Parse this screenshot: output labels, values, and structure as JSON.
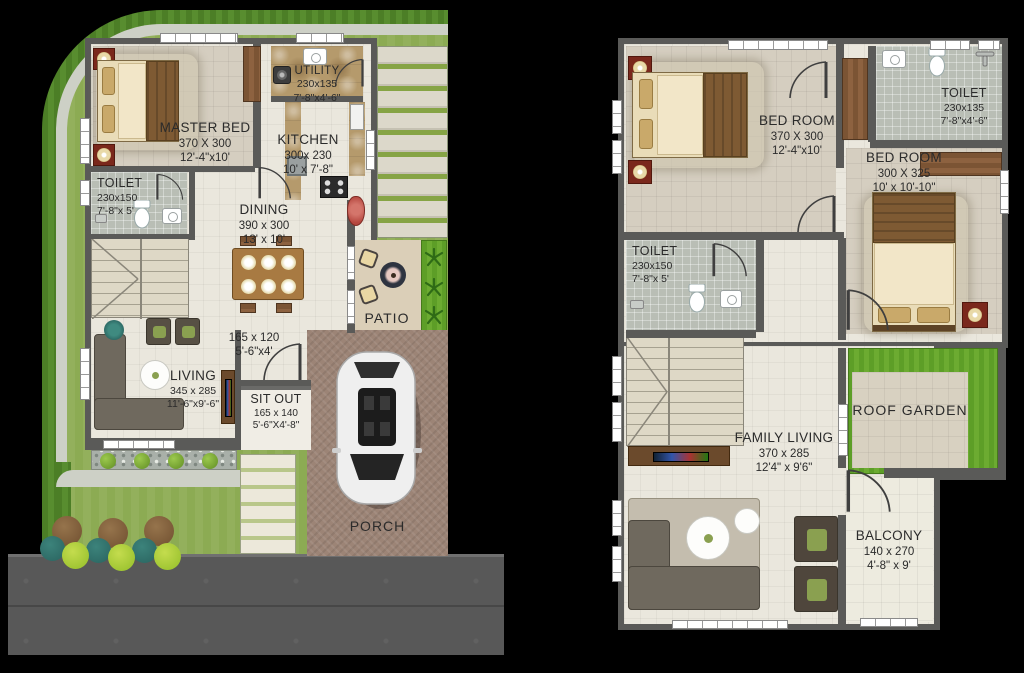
{
  "plans": {
    "ground_floor_note": "left plan",
    "first_floor_note": "right plan"
  },
  "ground_floor": {
    "rooms": {
      "master_bed": {
        "name": "MASTER BED",
        "dim_cm": "370 X 300",
        "dim_ft": "12'-4\"x10'"
      },
      "utility": {
        "name": "UTILITY",
        "dim_cm": "230x135",
        "dim_ft": "7'-8\"x4'-6\""
      },
      "kitchen": {
        "name": "KITCHEN",
        "dim_cm": "300x 230",
        "dim_ft": "10' x 7'-8\""
      },
      "toilet": {
        "name": "TOILET",
        "dim_cm": "230x150",
        "dim_ft": "7'-8\"x 5'"
      },
      "dining": {
        "name": "DINING",
        "dim_cm": "390 x 300",
        "dim_ft": "13' x 10'"
      },
      "patio": {
        "name": "PATIO"
      },
      "passage": {
        "dim_cm": "165 x 120",
        "dim_ft": "5'-6\"x4'"
      },
      "living": {
        "name": "LIVING",
        "dim_cm": "345 x 285",
        "dim_ft": "11'-6\"x9'-6\""
      },
      "sit_out": {
        "name": "SIT OUT",
        "dim_cm": "165 x 140",
        "dim_ft": "5'-6\"X4'-8\""
      },
      "porch": {
        "name": "PORCH"
      }
    }
  },
  "first_floor": {
    "rooms": {
      "bed_room_1": {
        "name": "BED ROOM",
        "dim_cm": "370 X 300",
        "dim_ft": "12'-4\"x10'"
      },
      "toilet_top": {
        "name": "TOILET",
        "dim_cm": "230x135",
        "dim_ft": "7'-8\"x4'-6\""
      },
      "bed_room_2": {
        "name": "BED ROOM",
        "dim_cm": "300 X 325",
        "dim_ft": "10' x 10'-10\""
      },
      "toilet_mid": {
        "name": "TOILET",
        "dim_cm": "230x150",
        "dim_ft": "7'-8\"x 5'"
      },
      "family_living": {
        "name": "FAMILY LIVING",
        "dim_cm": "370 x 285",
        "dim_ft": "12'4\" x 9'6\""
      },
      "roof_garden": {
        "name": "ROOF GARDEN"
      },
      "balcony": {
        "name": "BALCONY",
        "dim_cm": "140 x 270",
        "dim_ft": "4'-8\" x 9'"
      }
    }
  },
  "colors": {
    "background": "#000000",
    "wall": "#5a5a58",
    "floor": "#eae7dd",
    "carpet": "#d5cec0",
    "tile_gray": "#b9beb5",
    "marble": "#b59a6c",
    "wood_dark": "#6b4a2c",
    "lawn_outer": "#4c7e26",
    "lawn_inner": "#93b05c",
    "path": "#cdd0c6",
    "gravel": "#a9b0a9",
    "porch": "#9c8476",
    "road": "#585858",
    "roof_garden_grass": "#61a22b",
    "sofa": "#6f695e",
    "sofa_light": "#c4bdae",
    "accent_red": "#7a281c",
    "basin_red": "#b5473f",
    "label_text": "#2b2b2b",
    "bed_sheet": "#f2e6c8",
    "blanket": "#7e5a33",
    "pillow": "#c9a96a",
    "bush_teal": "#2e6b66",
    "bush_yellow": "#9fc532",
    "tree_brown": "#7b5a38",
    "cushion_green": "#8aa050"
  }
}
